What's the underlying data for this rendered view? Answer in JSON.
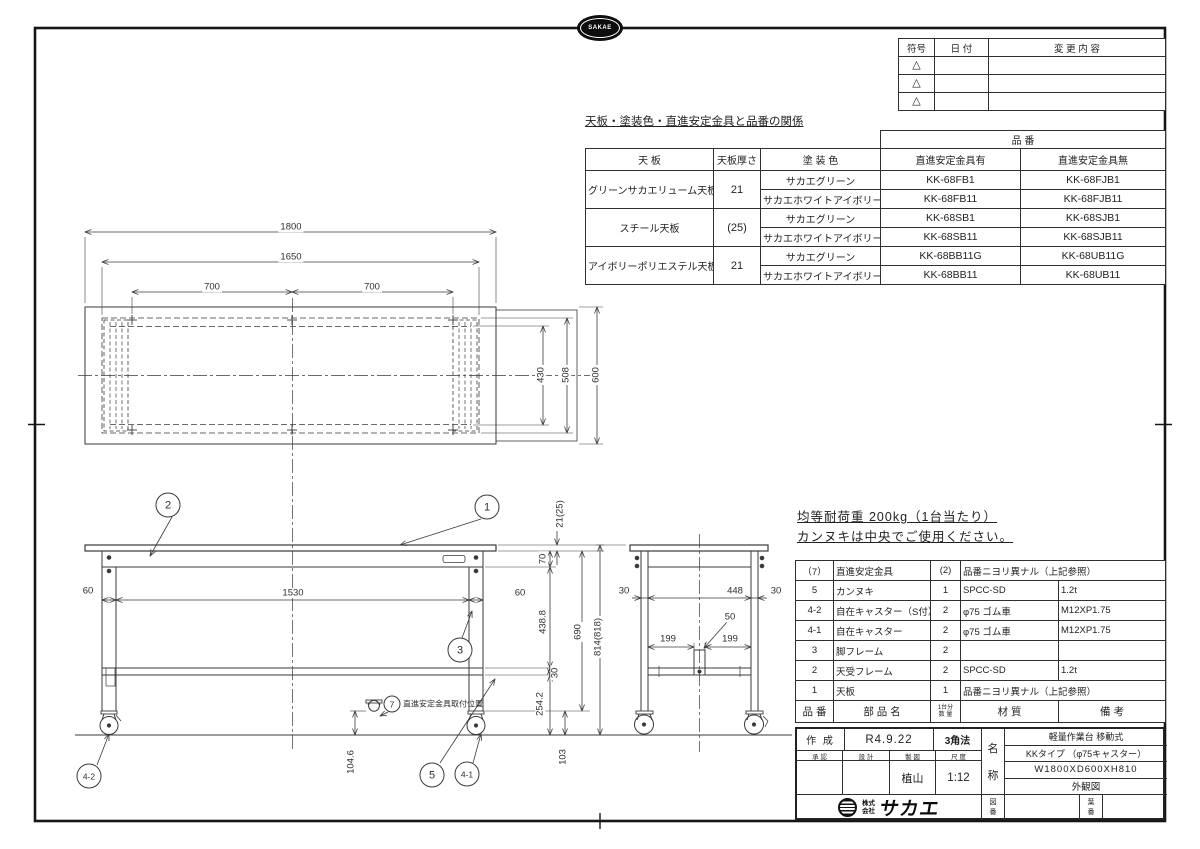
{
  "top_logo": {
    "text": "SAKAE"
  },
  "revision_table": {
    "headers": {
      "symbol": "符号",
      "date": "日  付",
      "content": "変 更 内 容"
    },
    "triangle": "△"
  },
  "relation_table": {
    "title": "天板・塗装色・直進安定金具と品番の関係",
    "part_no_header": "品  番",
    "headers": {
      "tenban": "天  板",
      "thickness": "天板厚さ",
      "color": "塗  装  色",
      "with_fitting": "直進安定金具有",
      "without_fitting": "直進安定金具無"
    },
    "groups": [
      {
        "tenban": "グリーンサカエリューム天板",
        "thickness": "21",
        "rows": [
          {
            "color": "サカエグリーン",
            "with": "KK-68FB1",
            "without": "KK-68FJB1"
          },
          {
            "color": "サカエホワイトアイボリー",
            "with": "KK-68FB11",
            "without": "KK-68FJB11"
          }
        ]
      },
      {
        "tenban": "スチール天板",
        "thickness": "(25)",
        "rows": [
          {
            "color": "サカエグリーン",
            "with": "KK-68SB1",
            "without": "KK-68SJB1"
          },
          {
            "color": "サカエホワイトアイボリー",
            "with": "KK-68SB11",
            "without": "KK-68SJB11"
          }
        ]
      },
      {
        "tenban": "アイボリーポリエステル天板",
        "thickness": "21",
        "rows": [
          {
            "color": "サカエグリーン",
            "with": "KK-68BB11G",
            "without": "KK-68UB11G"
          },
          {
            "color": "サカエホワイトアイボリー",
            "with": "KK-68BB11",
            "without": "KK-68UB11"
          }
        ]
      }
    ]
  },
  "notes": {
    "line1": "均等耐荷重  200kg（1台当たり）",
    "line2": "カンヌキは中央でご使用ください。"
  },
  "dims": {
    "d1800": "1800",
    "d1650": "1650",
    "d700": "700",
    "d430": "430",
    "d508": "508",
    "d600": "600",
    "d60": "60",
    "d1530": "1530",
    "d21": "21(25)",
    "d70": "70",
    "d438": "438.8",
    "d690": "690",
    "d814": "814(818)",
    "d30": "30",
    "d254": "254.2",
    "d103": "103",
    "d104": "104.6",
    "d448": "448",
    "d50": "50",
    "d199": "199"
  },
  "balloons": {
    "b1": "1",
    "b2": "2",
    "b3": "3",
    "b5": "5",
    "b7": "7",
    "b41": "4-1",
    "b42": "4-2"
  },
  "balloon7_note": "直進安定金具取付位置",
  "bom": {
    "header": {
      "part_no": "品 番",
      "name": "部 品 名",
      "qty_top": "1台分",
      "qty_bottom": "数 量",
      "material": "材   質",
      "remarks": "備   考"
    },
    "rows": [
      {
        "no": "（7）",
        "name": "直進安定金具",
        "qty": "(2)",
        "material": "品番ニヨリ異ナル（上記参照）",
        "remarks": ""
      },
      {
        "no": "5",
        "name": "カンヌキ",
        "qty": "1",
        "material": "SPCC-SD",
        "remarks": "1.2t"
      },
      {
        "no": "4-2",
        "name": "自在キャスター（S付）",
        "qty": "2",
        "material": "φ75  ゴム車",
        "remarks": "M12XP1.75"
      },
      {
        "no": "4-1",
        "name": "自在キャスター",
        "qty": "2",
        "material": "φ75  ゴム車",
        "remarks": "M12XP1.75"
      },
      {
        "no": "3",
        "name": "脚フレーム",
        "qty": "2",
        "material": "",
        "remarks": ""
      },
      {
        "no": "2",
        "name": "天受フレーム",
        "qty": "2",
        "material": "SPCC-SD",
        "remarks": "1.2t"
      },
      {
        "no": "1",
        "name": "天板",
        "qty": "1",
        "material": "品番ニヨリ異ナル（上記参照）",
        "remarks": ""
      }
    ]
  },
  "title_block": {
    "created_label": "作 成",
    "created_date": "R4.9.22",
    "projection": "3角法",
    "approve_label": "承 認",
    "design_label": "設 計",
    "draft_label": "製 図",
    "scale_label": "尺 度",
    "drafter": "植山",
    "scale": "1:12",
    "name_label_top": "名",
    "name_label_bottom": "称",
    "product_line1": "軽量作業台 移動式",
    "product_line2": "KKタイプ （φ75キャスター）",
    "product_line3": "W1800XD600XH810",
    "product_line4": "外観図",
    "drawing_no_top": "図",
    "drawing_no_bottom": "番",
    "sheet_no_top": "葉",
    "sheet_no_bottom": "番",
    "company_prefix_top": "株式",
    "company_prefix_bottom": "会社",
    "company_name": "サカエ"
  }
}
